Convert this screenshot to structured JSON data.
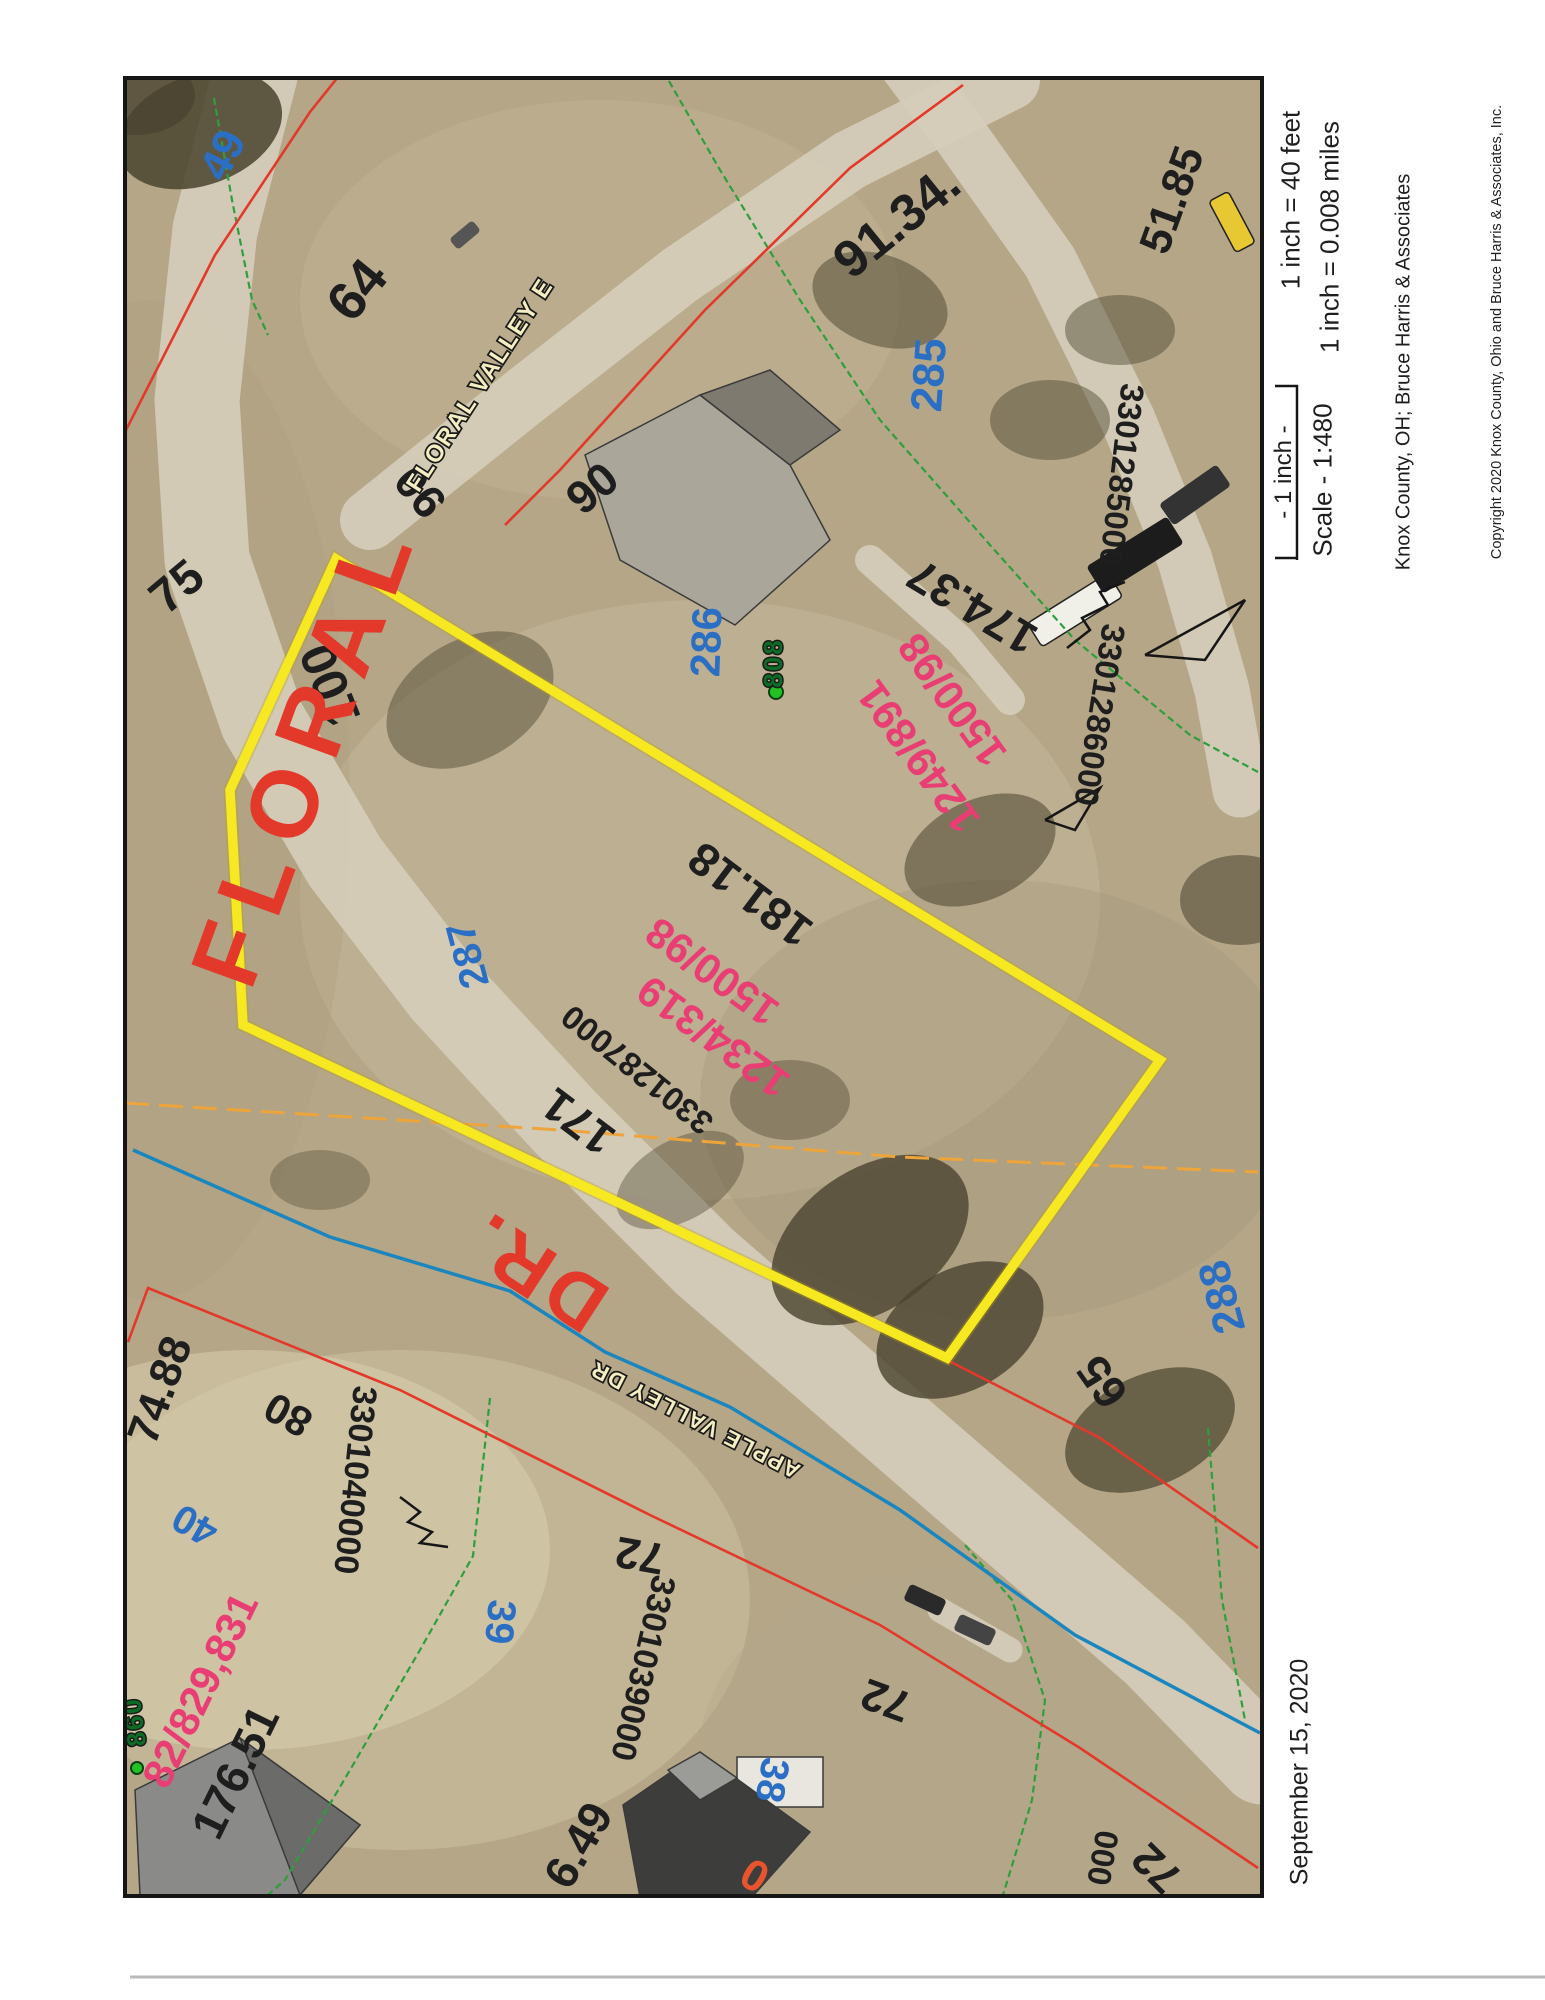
{
  "margin": {
    "scale_feet": "1 inch = 40 feet",
    "scale_miles": "1 inch = 0.008 miles",
    "scale_bar_label": "- 1 inch -",
    "scale_ratio": "Scale - 1:480",
    "attribution": "Knox County, OH; Bruce Harris & Associates",
    "copyright": "Copyright 2020 Knox County, Ohio and Bruce Harris & Associates, Inc.",
    "date": "September 15, 2020"
  },
  "colors": {
    "black_label": "#1e1e1e",
    "blue_label": "#2b6fc4",
    "pink_label": "#e83e74",
    "green_label": "#0c6b24",
    "orange_label": "#e8542e",
    "red_label": "#e2392b",
    "street_fill": "#f4eec2",
    "yellow_parcel": "#f6e821",
    "red_line": "#e2392b",
    "green_line": "#2f9e3c",
    "orange_line": "#eda43b",
    "stream_blue": "#1b86bd",
    "road": "#d5cdba",
    "aerial_base": "#b4a687",
    "border": "#161616"
  },
  "map": {
    "border": {
      "x": 125,
      "y": 78,
      "w": 1137,
      "h": 1818
    },
    "labels": [
      {
        "t": "64",
        "x": 357,
        "y": 290,
        "r": -51,
        "c": "k",
        "s": 54
      },
      {
        "t": "75",
        "x": 177,
        "y": 587,
        "r": -40,
        "c": "k",
        "s": 48
      },
      {
        "t": "90",
        "x": 420,
        "y": 492,
        "r": -130,
        "c": "k",
        "s": 46
      },
      {
        "t": "90",
        "x": 592,
        "y": 488,
        "r": -40,
        "c": "k",
        "s": 46
      },
      {
        "t": "91.34.",
        "x": 897,
        "y": 222,
        "r": -39,
        "c": "k",
        "s": 52
      },
      {
        "t": "51.85",
        "x": 1172,
        "y": 200,
        "r": -70,
        "c": "k",
        "s": 44
      },
      {
        "t": "3301285000",
        "x": 1122,
        "y": 475,
        "r": 97,
        "c": "k",
        "s": 33
      },
      {
        "t": "3301286000",
        "x": 1100,
        "y": 715,
        "r": 99,
        "c": "k",
        "s": 33
      },
      {
        "t": "174.37",
        "x": 972,
        "y": 607,
        "r": -149,
        "c": "k",
        "s": 46
      },
      {
        "t": "100",
        "x": 330,
        "y": 685,
        "r": -112,
        "c": "k",
        "s": 50
      },
      {
        "t": "181.18",
        "x": 750,
        "y": 895,
        "r": -143,
        "c": "k",
        "s": 46
      },
      {
        "t": "3301287000",
        "x": 637,
        "y": 1070,
        "r": -141,
        "c": "k",
        "s": 33
      },
      {
        "t": "171",
        "x": 578,
        "y": 1122,
        "r": -143,
        "c": "k",
        "s": 46
      },
      {
        "t": "74.88",
        "x": 160,
        "y": 1390,
        "r": -70,
        "c": "k",
        "s": 44
      },
      {
        "t": "80",
        "x": 288,
        "y": 1415,
        "r": -151,
        "c": "k",
        "s": 42
      },
      {
        "t": "176.51",
        "x": 235,
        "y": 1772,
        "r": -64,
        "c": "k",
        "s": 46
      },
      {
        "t": "6.49",
        "x": 578,
        "y": 1845,
        "r": -60,
        "c": "k",
        "s": 46
      },
      {
        "t": "3301040000",
        "x": 355,
        "y": 1480,
        "r": 96,
        "c": "k",
        "s": 34
      },
      {
        "t": "3301039000",
        "x": 643,
        "y": 1668,
        "r": 103,
        "c": "k",
        "s": 34
      },
      {
        "t": "72",
        "x": 640,
        "y": 1555,
        "r": -170,
        "c": "k",
        "s": 44
      },
      {
        "t": "72",
        "x": 886,
        "y": 1700,
        "r": -160,
        "c": "k",
        "s": 44
      },
      {
        "t": "72",
        "x": 1157,
        "y": 1868,
        "r": -135,
        "c": "k",
        "s": 44
      },
      {
        "t": "000",
        "x": 1103,
        "y": 1858,
        "r": 100,
        "c": "k",
        "s": 33
      },
      {
        "t": "65",
        "x": 1102,
        "y": 1382,
        "r": -125,
        "c": "k",
        "s": 46
      },
      {
        "t": "49",
        "x": 223,
        "y": 155,
        "r": -63,
        "c": "b",
        "s": 44
      },
      {
        "t": "285",
        "x": 929,
        "y": 375,
        "r": -86,
        "c": "b",
        "s": 44
      },
      {
        "t": "286",
        "x": 706,
        "y": 642,
        "r": -88,
        "c": "b",
        "s": 42
      },
      {
        "t": "287",
        "x": 468,
        "y": 955,
        "r": -105,
        "c": "b",
        "s": 40
      },
      {
        "t": "288",
        "x": 1222,
        "y": 1297,
        "r": -105,
        "c": "b",
        "s": 44
      },
      {
        "t": "40",
        "x": 195,
        "y": 1525,
        "r": -150,
        "c": "b",
        "s": 40
      },
      {
        "t": "39",
        "x": 500,
        "y": 1622,
        "r": 95,
        "c": "b",
        "s": 40
      },
      {
        "t": "38",
        "x": 772,
        "y": 1780,
        "r": 100,
        "c": "b",
        "s": 40
      },
      {
        "t": "1249/891",
        "x": 918,
        "y": 757,
        "r": -126,
        "c": "p",
        "s": 42
      },
      {
        "t": "1500/98",
        "x": 952,
        "y": 700,
        "r": -126,
        "c": "p",
        "s": 42
      },
      {
        "t": "1234/319",
        "x": 713,
        "y": 1037,
        "r": -144,
        "c": "p",
        "s": 42
      },
      {
        "t": "1500/98",
        "x": 712,
        "y": 972,
        "r": -144,
        "c": "p",
        "s": 42
      },
      {
        "t": "82/829,831",
        "x": 200,
        "y": 1690,
        "r": -64,
        "c": "p",
        "s": 42
      },
      {
        "t": "0",
        "x": 755,
        "y": 1875,
        "r": -150,
        "c": "o",
        "s": 44
      },
      {
        "t": "808",
        "x": 773,
        "y": 663,
        "r": -90,
        "c": "g",
        "s": 26
      },
      {
        "t": "860",
        "x": 134,
        "y": 1722,
        "r": -97,
        "c": "g",
        "s": 26
      },
      {
        "t": "FLORAL VALLEY E",
        "x": 480,
        "y": 385,
        "r": -57,
        "c": "st",
        "s": 24
      },
      {
        "t": "APPLE VALLEY DR",
        "x": 695,
        "y": 1420,
        "r": -153,
        "c": "st",
        "s": 22
      },
      {
        "t": "FLORAL",
        "x": 305,
        "y": 750,
        "r": -70,
        "c": "rd",
        "s": 95
      },
      {
        "t": "DR.",
        "x": 535,
        "y": 1272,
        "r": -147,
        "c": "rd",
        "s": 78
      }
    ],
    "yellow_parcel": [
      [
        336,
        559
      ],
      [
        1160,
        1060
      ],
      [
        947,
        1358
      ],
      [
        243,
        1025
      ],
      [
        230,
        790
      ]
    ],
    "red_lines": [
      [
        [
          125,
          432
        ],
        [
          215,
          255
        ],
        [
          310,
          112
        ],
        [
          350,
          62
        ]
      ],
      [
        [
          963,
          85
        ],
        [
          850,
          168
        ],
        [
          705,
          310
        ],
        [
          560,
          470
        ],
        [
          505,
          525
        ]
      ],
      [
        [
          128,
          1342
        ],
        [
          148,
          1288
        ],
        [
          400,
          1390
        ],
        [
          650,
          1515
        ],
        [
          880,
          1625
        ],
        [
          1080,
          1748
        ],
        [
          1258,
          1868
        ]
      ],
      [
        [
          947,
          1360
        ],
        [
          1100,
          1438
        ],
        [
          1258,
          1548
        ]
      ]
    ],
    "green_lines": [
      [
        [
          658,
          62
        ],
        [
          720,
          170
        ],
        [
          800,
          300
        ],
        [
          880,
          420
        ],
        [
          990,
          545
        ],
        [
          1075,
          640
        ],
        [
          1190,
          735
        ],
        [
          1258,
          772
        ]
      ],
      [
        [
          214,
          98
        ],
        [
          232,
          200
        ],
        [
          252,
          300
        ],
        [
          268,
          335
        ]
      ],
      [
        [
          490,
          1398
        ],
        [
          473,
          1556
        ],
        [
          420,
          1650
        ],
        [
          350,
          1770
        ],
        [
          285,
          1880
        ],
        [
          268,
          1895
        ]
      ],
      [
        [
          965,
          1545
        ],
        [
          1012,
          1600
        ],
        [
          1045,
          1700
        ],
        [
          1032,
          1800
        ],
        [
          1003,
          1895
        ]
      ],
      [
        [
          1208,
          1428
        ],
        [
          1222,
          1600
        ],
        [
          1245,
          1720
        ]
      ]
    ],
    "orange_line": [
      [
        125,
        1103
      ],
      [
        560,
        1130
      ],
      [
        900,
        1157
      ],
      [
        1258,
        1172
      ]
    ],
    "stream": [
      [
        133,
        1150
      ],
      [
        330,
        1237
      ],
      [
        510,
        1291
      ],
      [
        605,
        1352
      ],
      [
        730,
        1407
      ],
      [
        900,
        1510
      ],
      [
        1075,
        1635
      ],
      [
        1260,
        1733
      ]
    ],
    "roads": [
      {
        "pts": [
          [
            255,
            75
          ],
          [
            215,
            230
          ],
          [
            197,
            400
          ],
          [
            207,
            560
          ],
          [
            262,
            720
          ],
          [
            345,
            862
          ],
          [
            445,
            992
          ],
          [
            565,
            1122
          ],
          [
            705,
            1262
          ],
          [
            855,
            1392
          ],
          [
            1005,
            1522
          ],
          [
            1155,
            1652
          ],
          [
            1262,
            1762
          ]
        ],
        "w": 85
      },
      {
        "pts": [
          [
            370,
            520
          ],
          [
            520,
            400
          ],
          [
            680,
            275
          ],
          [
            850,
            160
          ],
          [
            1010,
            80
          ]
        ],
        "w": 60
      },
      {
        "pts": [
          [
            905,
            62
          ],
          [
            960,
            135
          ],
          [
            1050,
            262
          ],
          [
            1128,
            420
          ],
          [
            1185,
            560
          ],
          [
            1222,
            690
          ],
          [
            1240,
            790
          ]
        ],
        "w": 55
      },
      {
        "pts": [
          [
            870,
            560
          ],
          [
            960,
            640
          ],
          [
            1010,
            700
          ]
        ],
        "w": 30
      },
      {
        "pts": [
          [
            940,
            1610
          ],
          [
            1010,
            1650
          ]
        ],
        "w": 25
      }
    ],
    "houses": [
      {
        "pts": [
          [
            585,
            455
          ],
          [
            700,
            395
          ],
          [
            790,
            465
          ],
          [
            830,
            540
          ],
          [
            735,
            625
          ],
          [
            620,
            560
          ]
        ],
        "f": "#aaa69a"
      },
      {
        "pts": [
          [
            700,
            395
          ],
          [
            790,
            465
          ],
          [
            840,
            430
          ],
          [
            770,
            370
          ]
        ],
        "f": "#7e7a6f"
      },
      {
        "pts": [
          [
            135,
            1790
          ],
          [
            240,
            1738
          ],
          [
            360,
            1825
          ],
          [
            300,
            1895
          ],
          [
            140,
            1895
          ]
        ],
        "f": "#8a8a88"
      },
      {
        "pts": [
          [
            240,
            1738
          ],
          [
            360,
            1825
          ],
          [
            300,
            1895
          ]
        ],
        "f": "#6b6b69"
      },
      {
        "pts": [
          [
            737,
            1757
          ],
          [
            823,
            1757
          ],
          [
            823,
            1807
          ],
          [
            737,
            1807
          ]
        ],
        "f": "#e8e6df"
      },
      {
        "pts": [
          [
            623,
            1805
          ],
          [
            700,
            1752
          ],
          [
            810,
            1832
          ],
          [
            752,
            1897
          ],
          [
            640,
            1897
          ]
        ],
        "f": "#3d3d3b"
      },
      {
        "pts": [
          [
            668,
            1770
          ],
          [
            700,
            1752
          ],
          [
            737,
            1778
          ],
          [
            700,
            1800
          ]
        ],
        "f": "#9b9b97"
      }
    ],
    "trees": [
      {
        "x": 200,
        "y": 130,
        "rx": 85,
        "ry": 55,
        "r": -20,
        "o": 0.85
      },
      {
        "x": 135,
        "y": 95,
        "rx": 60,
        "ry": 40,
        "r": 0,
        "o": 0.8
      },
      {
        "x": 470,
        "y": 700,
        "rx": 90,
        "ry": 60,
        "r": -30,
        "o": 0.45
      },
      {
        "x": 880,
        "y": 300,
        "rx": 70,
        "ry": 45,
        "r": 20,
        "o": 0.5
      },
      {
        "x": 1050,
        "y": 420,
        "rx": 60,
        "ry": 40,
        "r": 0,
        "o": 0.45
      },
      {
        "x": 1120,
        "y": 330,
        "rx": 55,
        "ry": 35,
        "r": 0,
        "o": 0.45
      },
      {
        "x": 980,
        "y": 850,
        "rx": 80,
        "ry": 50,
        "r": -25,
        "o": 0.55
      },
      {
        "x": 870,
        "y": 1240,
        "rx": 110,
        "ry": 70,
        "r": -35,
        "o": 0.8
      },
      {
        "x": 960,
        "y": 1330,
        "rx": 90,
        "ry": 60,
        "r": -30,
        "o": 0.8
      },
      {
        "x": 1150,
        "y": 1430,
        "rx": 90,
        "ry": 55,
        "r": -25,
        "o": 0.7
      },
      {
        "x": 1240,
        "y": 900,
        "rx": 60,
        "ry": 45,
        "r": 0,
        "o": 0.55
      },
      {
        "x": 320,
        "y": 1180,
        "rx": 50,
        "ry": 30,
        "r": 0,
        "o": 0.35
      },
      {
        "x": 680,
        "y": 1180,
        "rx": 70,
        "ry": 40,
        "r": -30,
        "o": 0.4
      },
      {
        "x": 790,
        "y": 1100,
        "rx": 60,
        "ry": 40,
        "r": 0,
        "o": 0.4
      }
    ],
    "patches": [
      {
        "x": 700,
        "y": 900,
        "rx": 400,
        "ry": 300,
        "f": "#c7bb9d",
        "o": 0.45
      },
      {
        "x": 400,
        "y": 1600,
        "rx": 350,
        "ry": 250,
        "f": "#cfc3a4",
        "o": 0.5
      },
      {
        "x": 1000,
        "y": 1100,
        "rx": 300,
        "ry": 220,
        "f": "#a2947a",
        "o": 0.35
      },
      {
        "x": 600,
        "y": 300,
        "rx": 300,
        "ry": 200,
        "f": "#c3b795",
        "o": 0.4
      },
      {
        "x": 950,
        "y": 1750,
        "rx": 250,
        "ry": 180,
        "f": "#b5a98c",
        "o": 0.4
      },
      {
        "x": 150,
        "y": 800,
        "rx": 200,
        "ry": 500,
        "f": "#ab9d7e",
        "o": 0.35
      },
      {
        "x": 250,
        "y": 1550,
        "rx": 300,
        "ry": 200,
        "f": "#d8cdae",
        "o": 0.55
      }
    ],
    "vehicles": [
      {
        "x": 1075,
        "y": 610,
        "w": 95,
        "h": 28,
        "r": -32,
        "f": "#f0efe8",
        "st": "#222222"
      },
      {
        "x": 1135,
        "y": 555,
        "w": 95,
        "h": 32,
        "r": -32,
        "f": "#1c1c1c",
        "st": "none"
      },
      {
        "x": 1195,
        "y": 495,
        "w": 70,
        "h": 26,
        "r": -35,
        "f": "#333333",
        "st": "none"
      },
      {
        "x": 925,
        "y": 1600,
        "w": 40,
        "h": 18,
        "r": 25,
        "f": "#2a2a2a",
        "st": "none"
      },
      {
        "x": 975,
        "y": 1630,
        "w": 40,
        "h": 18,
        "r": 25,
        "f": "#444444",
        "st": "none"
      },
      {
        "x": 1232,
        "y": 222,
        "w": 58,
        "h": 22,
        "r": 62,
        "f": "#e8c832",
        "st": "#222222"
      },
      {
        "x": 465,
        "y": 235,
        "w": 30,
        "h": 14,
        "r": -40,
        "f": "#555555",
        "st": "none"
      }
    ],
    "zigzags": [
      [
        [
          400,
          1497
        ],
        [
          420,
          1512
        ],
        [
          408,
          1522
        ],
        [
          432,
          1532
        ],
        [
          420,
          1543
        ],
        [
          448,
          1547
        ]
      ],
      [
        [
          1067,
          648
        ],
        [
          1090,
          630
        ],
        [
          1082,
          618
        ],
        [
          1108,
          605
        ],
        [
          1100,
          592
        ],
        [
          1125,
          582
        ]
      ],
      [
        [
          1145,
          655
        ],
        [
          1245,
          600
        ],
        [
          1205,
          660
        ],
        [
          1145,
          655
        ]
      ],
      [
        [
          1045,
          820
        ],
        [
          1100,
          788
        ],
        [
          1075,
          830
        ],
        [
          1045,
          820
        ]
      ]
    ],
    "green_dots": [
      {
        "x": 776,
        "y": 692,
        "r": 7
      },
      {
        "x": 137,
        "y": 1768,
        "r": 6
      }
    ]
  }
}
